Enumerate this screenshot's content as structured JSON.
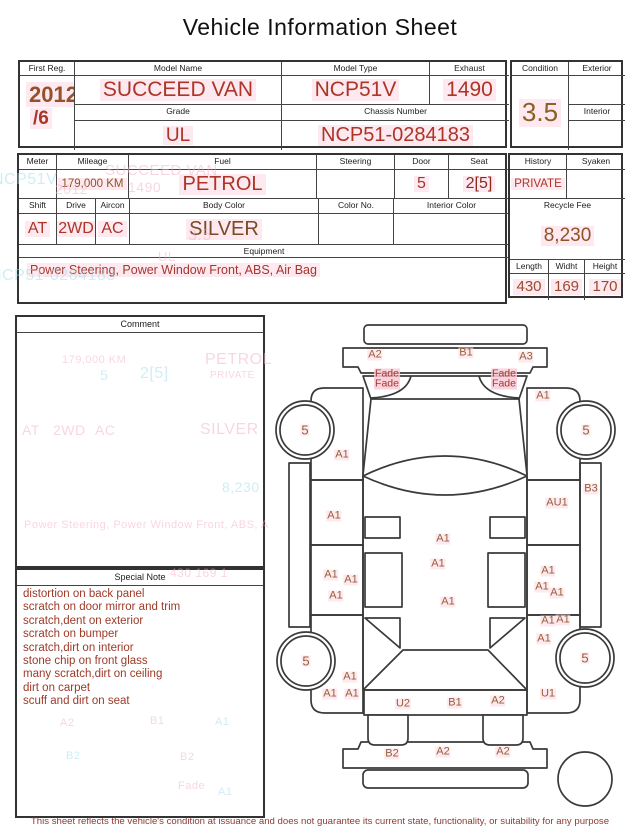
{
  "title": "Vehicle Information Sheet",
  "top_table": {
    "first_reg": {
      "label": "First Reg.",
      "year": "2012",
      "month": "/6"
    },
    "model_name": {
      "label": "Model Name",
      "value": "SUCCEED VAN"
    },
    "model_type": {
      "label": "Model Type",
      "value": "NCP51V"
    },
    "exhaust": {
      "label": "Exhaust",
      "value": "1490"
    },
    "grade": {
      "label": "Grade",
      "value": "UL"
    },
    "chassis_number": {
      "label": "Chassis Number",
      "value": "NCP51-0284183"
    },
    "condition": {
      "label": "Condition",
      "value": "3.5"
    },
    "exterior": {
      "label": "Exterior",
      "value": ""
    },
    "interior": {
      "label": "Interior",
      "value": ""
    }
  },
  "spec_table": {
    "meter": {
      "label": "Meter",
      "value": ""
    },
    "mileage": {
      "label": "Mileage",
      "value": "179,000 KM"
    },
    "fuel": {
      "label": "Fuel",
      "value": "PETROL"
    },
    "steering": {
      "label": "Steering",
      "value": ""
    },
    "door": {
      "label": "Door",
      "value": "5"
    },
    "seat": {
      "label": "Seat",
      "value": "2[5]"
    },
    "shift": {
      "label": "Shift",
      "value": "AT"
    },
    "drive": {
      "label": "Drive",
      "value": "2WD"
    },
    "aircon": {
      "label": "Aircon",
      "value": "AC"
    },
    "body_color": {
      "label": "Body Color",
      "value": "SILVER"
    },
    "color_no": {
      "label": "Color No.",
      "value": ""
    },
    "interior_color": {
      "label": "Interior Color",
      "value": ""
    },
    "equipment": {
      "label": "Equipment",
      "value": "Power Steering, Power Window  Front, ABS, Air Bag"
    },
    "history": {
      "label": "History",
      "value": "PRIVATE"
    },
    "syaken": {
      "label": "Syaken",
      "value": ""
    },
    "recycle_fee": {
      "label": "Recycle Fee",
      "value": "8,230"
    },
    "length": {
      "label": "Length",
      "value": "430"
    },
    "widht": {
      "label": "Widht",
      "value": "169"
    },
    "height": {
      "label": "Height",
      "value": "170"
    }
  },
  "comment": {
    "label": "Comment"
  },
  "special_note": {
    "label": "Special Note",
    "lines": [
      "distortion on back panel",
      "scratch on door mirror and trim",
      "scratch,dent on exterior",
      "scratch on bumper",
      "scratch,dirt on interior",
      "stone chip on front glass",
      "many scratch,dirt on ceiling",
      "dirt on carpet",
      "scuff and dirt on seat"
    ]
  },
  "diagram": {
    "damage_labels": [
      {
        "t": "A2",
        "x": 375,
        "y": 355
      },
      {
        "t": "B1",
        "x": 466,
        "y": 353
      },
      {
        "t": "A3",
        "x": 526,
        "y": 357
      },
      {
        "t": "Fade",
        "x": 387,
        "y": 374,
        "f": 1
      },
      {
        "t": "Fade",
        "x": 387,
        "y": 384,
        "f": 1
      },
      {
        "t": "Fade",
        "x": 504,
        "y": 374,
        "f": 1
      },
      {
        "t": "Fade",
        "x": 504,
        "y": 384,
        "f": 1
      },
      {
        "t": "A1",
        "x": 543,
        "y": 396
      },
      {
        "t": "5",
        "x": 305,
        "y": 430,
        "s": 13
      },
      {
        "t": "5",
        "x": 586,
        "y": 430,
        "s": 13
      },
      {
        "t": "A1",
        "x": 342,
        "y": 455
      },
      {
        "t": "B3",
        "x": 591,
        "y": 489
      },
      {
        "t": "AU1",
        "x": 557,
        "y": 503
      },
      {
        "t": "A1",
        "x": 334,
        "y": 516
      },
      {
        "t": "A1",
        "x": 443,
        "y": 539
      },
      {
        "t": "A1",
        "x": 438,
        "y": 564
      },
      {
        "t": "A1",
        "x": 331,
        "y": 575
      },
      {
        "t": "A1",
        "x": 351,
        "y": 580
      },
      {
        "t": "A1",
        "x": 336,
        "y": 596
      },
      {
        "t": "A1",
        "x": 448,
        "y": 602
      },
      {
        "t": "A1",
        "x": 548,
        "y": 571
      },
      {
        "t": "A1",
        "x": 542,
        "y": 587
      },
      {
        "t": "A1",
        "x": 557,
        "y": 593
      },
      {
        "t": "A1",
        "x": 548,
        "y": 621
      },
      {
        "t": "A1",
        "x": 563,
        "y": 620
      },
      {
        "t": "A1",
        "x": 544,
        "y": 639
      },
      {
        "t": "5",
        "x": 306,
        "y": 661,
        "s": 13
      },
      {
        "t": "5",
        "x": 585,
        "y": 658,
        "s": 13
      },
      {
        "t": "A1",
        "x": 350,
        "y": 677
      },
      {
        "t": "A1",
        "x": 330,
        "y": 694
      },
      {
        "t": "A1",
        "x": 352,
        "y": 694
      },
      {
        "t": "U1",
        "x": 548,
        "y": 694
      },
      {
        "t": "U2",
        "x": 403,
        "y": 704
      },
      {
        "t": "B1",
        "x": 455,
        "y": 703
      },
      {
        "t": "A2",
        "x": 498,
        "y": 701
      },
      {
        "t": "B2",
        "x": 392,
        "y": 754
      },
      {
        "t": "A2",
        "x": 443,
        "y": 752
      },
      {
        "t": "A2",
        "x": 503,
        "y": 752
      }
    ]
  },
  "ghost_texts": [
    {
      "t": "NCP51V",
      "x": -8,
      "y": 172,
      "c": "cyan",
      "s": 16
    },
    {
      "t": "SUCCEED VAN",
      "x": 105,
      "y": 163,
      "c": "pink",
      "s": 15
    },
    {
      "t": "1490",
      "x": 128,
      "y": 180,
      "c": "pink",
      "s": 14
    },
    {
      "t": "2012",
      "x": 55,
      "y": 182,
      "c": "pink",
      "s": 14
    },
    {
      "t": "3.5",
      "x": 188,
      "y": 228,
      "c": "pink",
      "s": 16
    },
    {
      "t": "UL",
      "x": 158,
      "y": 250,
      "c": "pink",
      "s": 13
    },
    {
      "t": "NCP51-0284183",
      "x": -10,
      "y": 268,
      "c": "cyan",
      "s": 16
    },
    {
      "t": "179,000 KM",
      "x": 62,
      "y": 355,
      "c": "pink",
      "s": 11
    },
    {
      "t": "5",
      "x": 100,
      "y": 368,
      "c": "cyan",
      "s": 14
    },
    {
      "t": "2[5]",
      "x": 140,
      "y": 366,
      "c": "cyan",
      "s": 16
    },
    {
      "t": "PETROL",
      "x": 205,
      "y": 352,
      "c": "pink",
      "s": 16
    },
    {
      "t": "PRIVATE",
      "x": 210,
      "y": 371,
      "c": "pink",
      "s": 10
    },
    {
      "t": "AT",
      "x": 22,
      "y": 423,
      "c": "pink",
      "s": 14
    },
    {
      "t": "2WD",
      "x": 53,
      "y": 423,
      "c": "pink",
      "s": 14
    },
    {
      "t": "AC",
      "x": 95,
      "y": 423,
      "c": "pink",
      "s": 14
    },
    {
      "t": "SILVER",
      "x": 200,
      "y": 422,
      "c": "pink",
      "s": 16
    },
    {
      "t": "8,230",
      "x": 222,
      "y": 480,
      "c": "cyan",
      "s": 14
    },
    {
      "t": "Power Steering, Power Window Front, ABS, A",
      "x": 24,
      "y": 520,
      "c": "pink",
      "s": 11
    },
    {
      "t": "430  169  1",
      "x": 170,
      "y": 567,
      "c": "pink",
      "s": 12
    },
    {
      "t": "A2",
      "x": 60,
      "y": 718,
      "c": "pink",
      "s": 11
    },
    {
      "t": "B1",
      "x": 150,
      "y": 716,
      "c": "pink",
      "s": 11
    },
    {
      "t": "A1",
      "x": 215,
      "y": 717,
      "c": "cyan",
      "s": 11
    },
    {
      "t": "B2",
      "x": 66,
      "y": 751,
      "c": "cyan",
      "s": 11
    },
    {
      "t": "B2",
      "x": 180,
      "y": 752,
      "c": "pink",
      "s": 11
    },
    {
      "t": "Fade",
      "x": 178,
      "y": 781,
      "c": "pink",
      "s": 11
    },
    {
      "t": "A1",
      "x": 218,
      "y": 787,
      "c": "cyan",
      "s": 11
    }
  ],
  "footer": {
    "disclaimer": "This sheet reflects the vehicle's condition at issuance and does not guarantee its current state, functionality, or suitability for any purpose"
  },
  "colors": {
    "value_red": "#ac3527",
    "value_brown": "#8d5528",
    "condition_gold": "#8a6024",
    "damage_sienna": "#9b5c36",
    "highlight_pink": "#fde9ef",
    "line_dark": "#3a3a3a",
    "ghost_pink": "#f3afc4",
    "ghost_cyan": "#9fdcea"
  }
}
